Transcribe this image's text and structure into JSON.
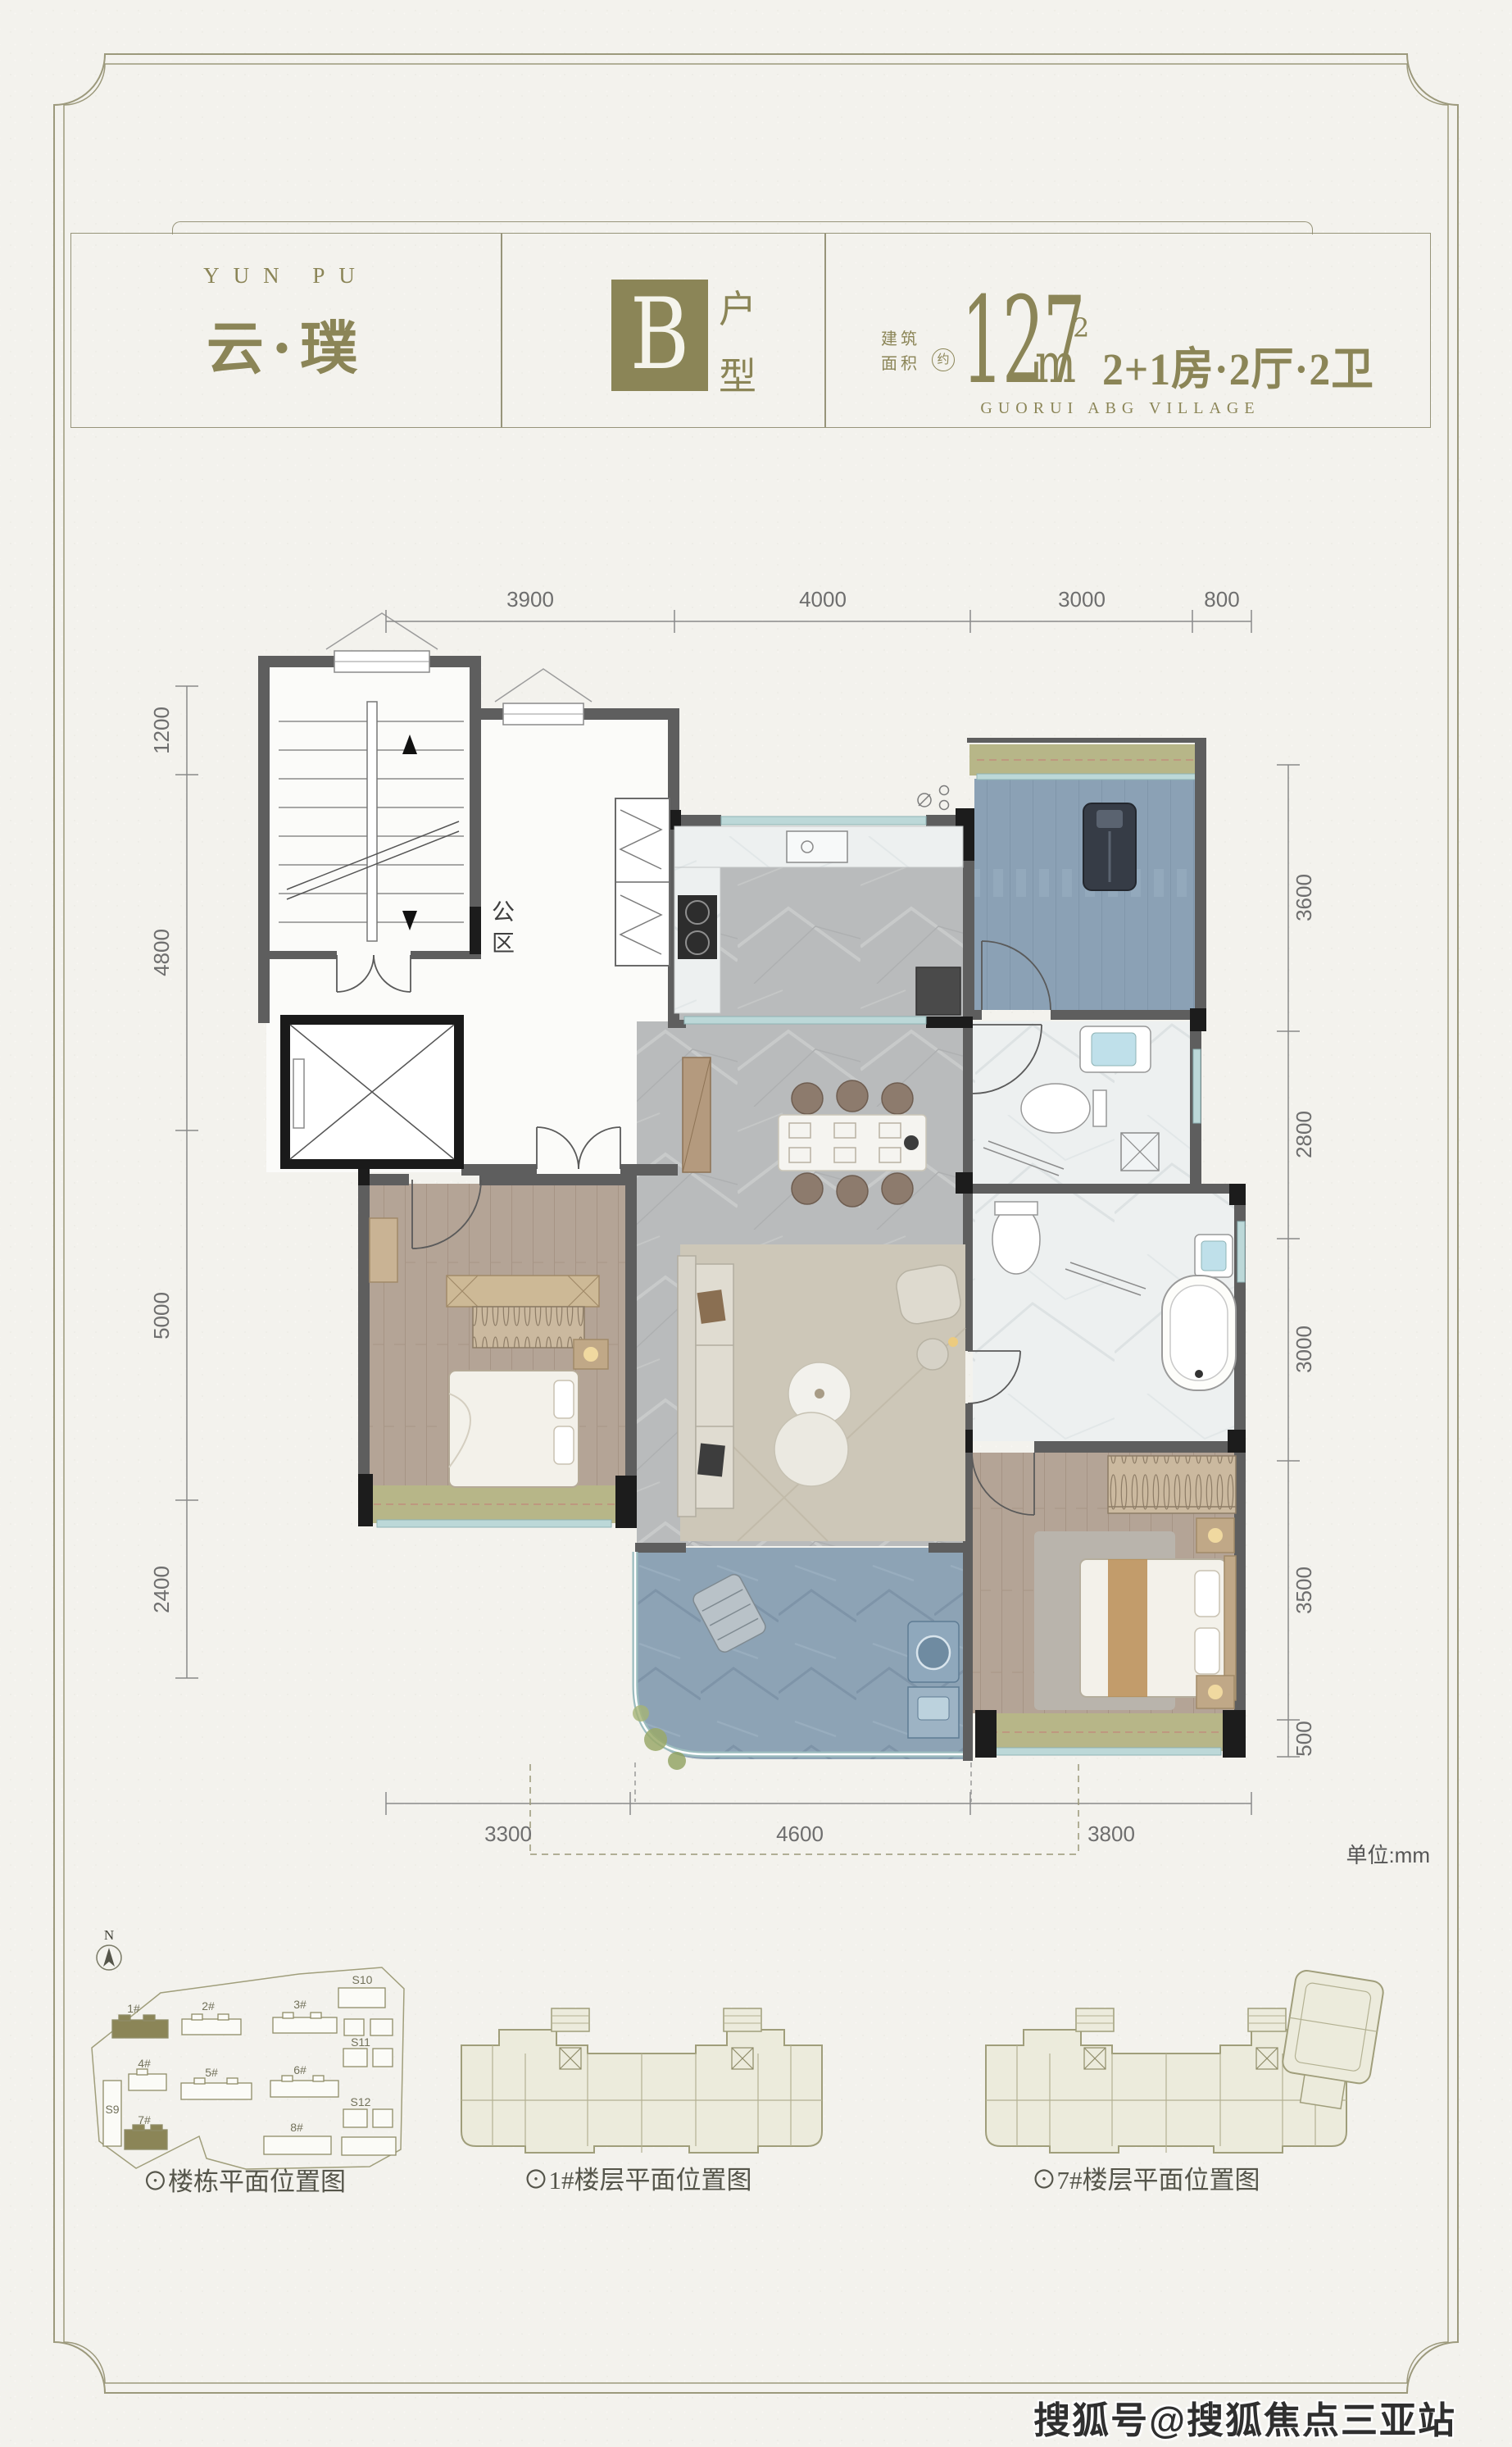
{
  "header": {
    "brand_en": "YUN PU",
    "brand_cn": "云·璞",
    "unit_letter": "B",
    "unit_word_1": "户",
    "unit_word_2": "型",
    "area_label_1": "建筑",
    "area_label_2": "面积",
    "area_approx": "约",
    "area_value": "127",
    "area_unit_base": "m",
    "area_unit_sup": "2",
    "layout_text": "2+1房·2厅·2卫",
    "project_en": "GUORUI ABG VILLAGE"
  },
  "plan": {
    "public_label": [
      "公",
      "区"
    ],
    "unit_note": "单位:mm",
    "dims": {
      "top": [
        "3900",
        "4000",
        "3000",
        "800"
      ],
      "left": [
        "1200",
        "4800",
        "5000",
        "2400"
      ],
      "right": [
        "3600",
        "2800",
        "3000",
        "3500",
        "500"
      ],
      "bottom": [
        "3300",
        "4600",
        "3800"
      ]
    }
  },
  "site": {
    "compass": "N",
    "captions": {
      "left": "⊙楼栋平面位置图",
      "middle": "⊙1#楼层平面位置图",
      "right": "⊙7#楼层平面位置图"
    },
    "buildings": {
      "b1": "1#",
      "b2": "2#",
      "b3": "3#",
      "b4": "4#",
      "b5": "5#",
      "b6": "6#",
      "b7": "7#",
      "b8": "8#",
      "s9": "S9",
      "s10": "S10",
      "s11": "S11",
      "s12": "S12"
    }
  },
  "watermark": "搜狐号@搜狐焦点三亚站",
  "colors": {
    "olive": "#8b8557",
    "paper": "#f3f2ed",
    "wall": "#5e5e5e",
    "dim": "#6e6e6e"
  }
}
